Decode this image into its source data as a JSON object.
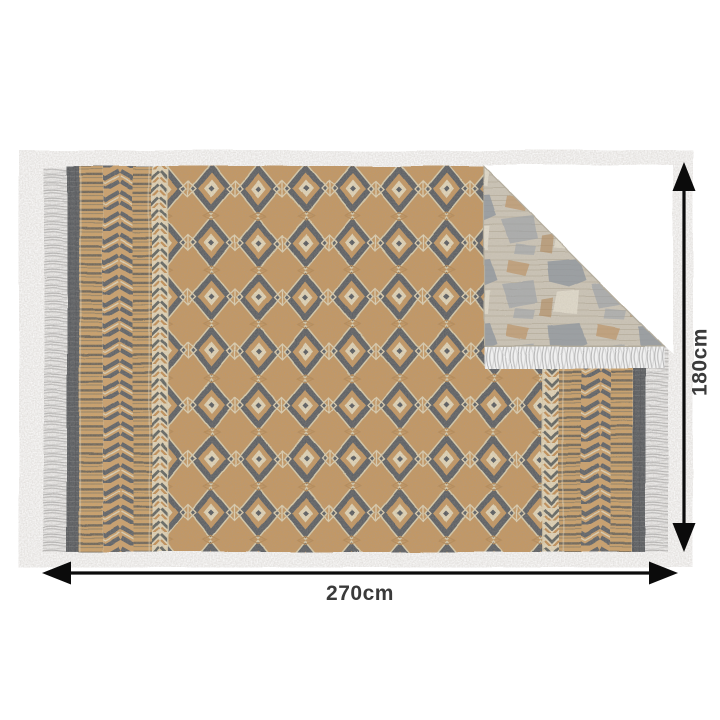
{
  "diagram": {
    "type": "product-dimension-diagram",
    "subject": "reversible fringed area rug with folded corner showing reverse side",
    "width_label": "270cm",
    "height_label": "180cm"
  },
  "style": {
    "background": "#ffffff",
    "arrow_color": "#0b0b0b",
    "label_color": "#3a3a3a",
    "rug_front_tan": "#c6975f",
    "rug_front_dark_grey": "#585c61",
    "rug_front_cream": "#e7dabb",
    "rug_back_base": "#cdc6b8",
    "rug_back_grey_patch": "#8e969f",
    "rug_back_tan_patch": "#bf9565",
    "fringe_color": "#ededed"
  }
}
